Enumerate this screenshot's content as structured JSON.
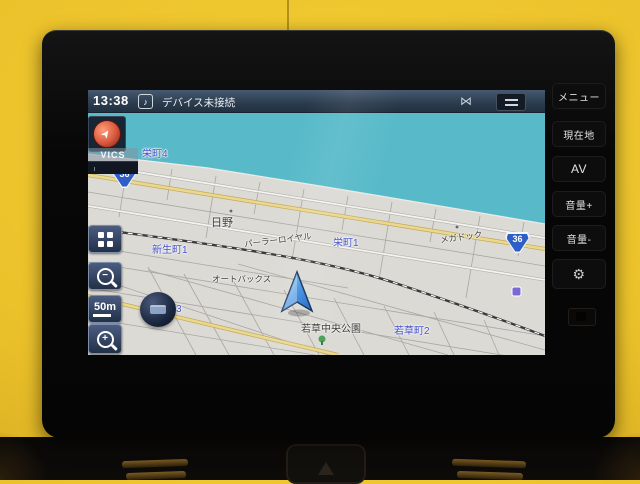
{
  "screen": {
    "status_bar": {
      "time": "13:38",
      "message": "デバイス未接続"
    },
    "map": {
      "vics_label": "VICS",
      "scale_label": "50m",
      "route_shields": [
        {
          "number": "36"
        },
        {
          "number": "36"
        }
      ],
      "labels": [
        {
          "text": "栄町4",
          "type": "district"
        },
        {
          "text": "日野",
          "type": "place"
        },
        {
          "text": "パーラーロイヤル",
          "type": "poi"
        },
        {
          "text": "栄町1",
          "type": "district"
        },
        {
          "text": "メガドック",
          "type": "poi"
        },
        {
          "text": "新生町1",
          "type": "district"
        },
        {
          "text": "新生局",
          "type": "poi"
        },
        {
          "text": "オートバックス",
          "type": "poi"
        },
        {
          "text": "新生町3",
          "type": "district"
        },
        {
          "text": "若草中央公園",
          "type": "park"
        },
        {
          "text": "若草町2",
          "type": "district"
        }
      ]
    }
  },
  "hard_buttons": [
    {
      "label": "メニュー"
    },
    {
      "label": "現在地"
    },
    {
      "label": "AV"
    },
    {
      "label": "音量+"
    },
    {
      "label": "音量-"
    }
  ],
  "icons": {
    "music_note": "♪",
    "no_signal": "⋈",
    "gear": "⚙",
    "compass_arrow": "➤"
  },
  "colors": {
    "water": "#58bac9",
    "land": "#dcdad5",
    "route_yellow": "#ead892",
    "shield_blue": "#2e5ec6",
    "label_blue": "#4753cf",
    "status_bar": "#2b3c4e",
    "wall_yellow": "#ecc22b"
  }
}
